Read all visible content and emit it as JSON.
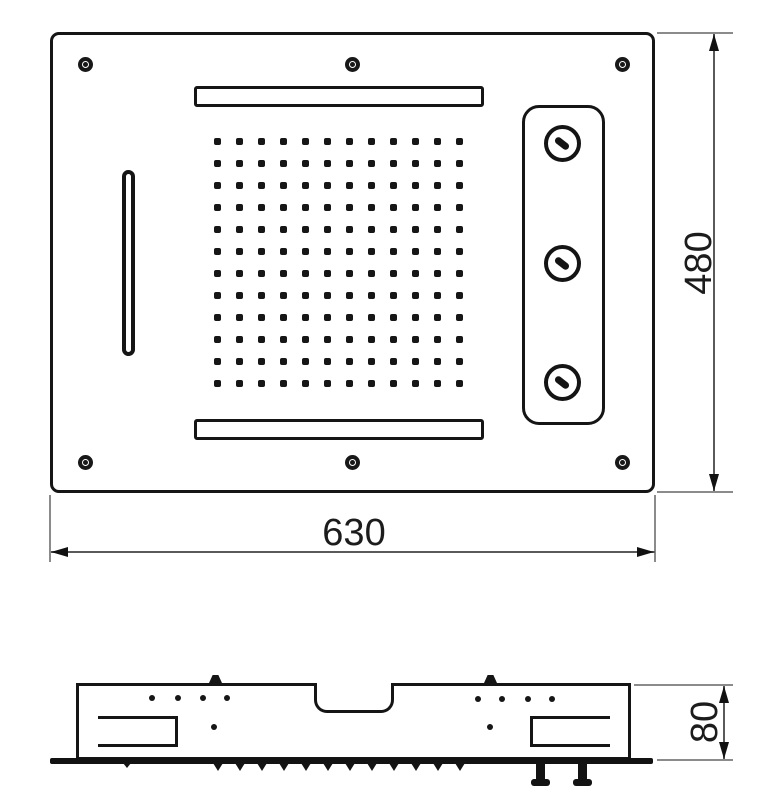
{
  "drawing": {
    "type": "technical-drawing",
    "subject": "ceiling shower head plan and section views",
    "colors": {
      "line": "#151515",
      "dim_line": "#5a5a5a",
      "ext_line": "#8b8b8b",
      "background": "#ffffff",
      "text": "#1c1c1c"
    }
  },
  "dimensions": {
    "width_label": "630",
    "height_label": "480",
    "depth_label": "80"
  },
  "top_view": {
    "screw_holes": [
      [
        85,
        64
      ],
      [
        352,
        64
      ],
      [
        622,
        64
      ],
      [
        85,
        462
      ],
      [
        352,
        462
      ],
      [
        622,
        462
      ]
    ],
    "nozzle_grid": {
      "rows": 12,
      "cols": 12,
      "start_x": 217,
      "start_y": 141,
      "spacing": 22,
      "dot_size": 7
    },
    "jets": [
      [
        562,
        143
      ],
      [
        562,
        263
      ],
      [
        562,
        382
      ]
    ]
  },
  "side_view": {
    "upper_dots": [
      [
        152,
        698
      ],
      [
        178,
        698
      ],
      [
        203,
        698
      ],
      [
        227,
        698
      ],
      [
        478,
        699
      ],
      [
        502,
        699
      ],
      [
        528,
        699
      ],
      [
        552,
        699
      ]
    ],
    "lower_dots": [
      [
        214,
        727
      ],
      [
        490,
        727
      ]
    ],
    "pegs_x": [
      209,
      484
    ],
    "teeth_xs": [
      218,
      240,
      262,
      284,
      306,
      328,
      350,
      372,
      394,
      416,
      438,
      460
    ],
    "nub_x": 127,
    "bolts_x": [
      536,
      578
    ]
  }
}
